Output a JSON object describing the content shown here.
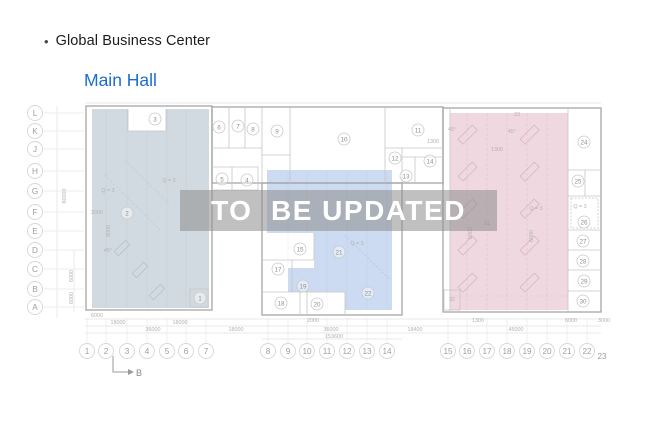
{
  "header": {
    "bullet": "•",
    "title": "Global Business Center",
    "subtitle": "Main Hall"
  },
  "watermark": "TO  BE UPDATED",
  "colors": {
    "subtitle_blue": "#1c6cd3",
    "zone_left": "#cdd6de",
    "zone_middle": "#c6d7f0",
    "zone_right": "#eed4dd",
    "watermark_band": "rgba(140,140,140,0.55)",
    "watermark_text": "#ffffff"
  },
  "plan": {
    "section_label": "B",
    "axis_rows": [
      {
        "label": "L",
        "y": 113
      },
      {
        "label": "K",
        "y": 131
      },
      {
        "label": "J",
        "y": 149
      },
      {
        "label": "H",
        "y": 171
      },
      {
        "label": "G",
        "y": 191
      },
      {
        "label": "F",
        "y": 212
      },
      {
        "label": "E",
        "y": 231
      },
      {
        "label": "D",
        "y": 250
      },
      {
        "label": "C",
        "y": 269
      },
      {
        "label": "B",
        "y": 289
      },
      {
        "label": "A",
        "y": 307
      }
    ],
    "axis_cols": [
      {
        "label": "1",
        "x": 87
      },
      {
        "label": "2",
        "x": 106
      },
      {
        "label": "3",
        "x": 127
      },
      {
        "label": "4",
        "x": 147
      },
      {
        "label": "5",
        "x": 167
      },
      {
        "label": "6",
        "x": 186
      },
      {
        "label": "7",
        "x": 206
      },
      {
        "label": "8",
        "x": 268
      },
      {
        "label": "9",
        "x": 288
      },
      {
        "label": "10",
        "x": 307
      },
      {
        "label": "11",
        "x": 327
      },
      {
        "label": "12",
        "x": 347
      },
      {
        "label": "13",
        "x": 367
      },
      {
        "label": "14",
        "x": 387
      },
      {
        "label": "15",
        "x": 448
      },
      {
        "label": "16",
        "x": 467
      },
      {
        "label": "17",
        "x": 487
      },
      {
        "label": "18",
        "x": 507
      },
      {
        "label": "19",
        "x": 527
      },
      {
        "label": "20",
        "x": 547
      },
      {
        "label": "21",
        "x": 567
      },
      {
        "label": "22",
        "x": 587
      },
      {
        "label": "23",
        "x": 602,
        "plain": true
      }
    ],
    "rooms": [
      {
        "n": "1",
        "x": 200,
        "y": 298
      },
      {
        "n": "2",
        "x": 127,
        "y": 213
      },
      {
        "n": "3",
        "x": 155,
        "y": 119
      },
      {
        "n": "4",
        "x": 247,
        "y": 180
      },
      {
        "n": "5",
        "x": 222,
        "y": 179
      },
      {
        "n": "6",
        "x": 219,
        "y": 127
      },
      {
        "n": "7",
        "x": 238,
        "y": 126
      },
      {
        "n": "8",
        "x": 253,
        "y": 129
      },
      {
        "n": "9",
        "x": 277,
        "y": 131
      },
      {
        "n": "10",
        "x": 344,
        "y": 139
      },
      {
        "n": "11",
        "x": 418,
        "y": 130
      },
      {
        "n": "12",
        "x": 395,
        "y": 158
      },
      {
        "n": "13",
        "x": 406,
        "y": 176
      },
      {
        "n": "14",
        "x": 430,
        "y": 161
      },
      {
        "n": "15",
        "x": 300,
        "y": 249
      },
      {
        "n": "17",
        "x": 278,
        "y": 269
      },
      {
        "n": "18",
        "x": 281,
        "y": 303
      },
      {
        "n": "19",
        "x": 303,
        "y": 286
      },
      {
        "n": "20",
        "x": 317,
        "y": 304
      },
      {
        "n": "21",
        "x": 339,
        "y": 252
      },
      {
        "n": "22",
        "x": 368,
        "y": 293
      },
      {
        "n": "24",
        "x": 584,
        "y": 142
      },
      {
        "n": "25",
        "x": 578,
        "y": 181
      },
      {
        "n": "26",
        "x": 584,
        "y": 222
      },
      {
        "n": "27",
        "x": 583,
        "y": 241
      },
      {
        "n": "28",
        "x": 583,
        "y": 261
      },
      {
        "n": "29",
        "x": 584,
        "y": 281
      },
      {
        "n": "30",
        "x": 583,
        "y": 301
      }
    ],
    "texts": [
      {
        "t": "23",
        "x": 517,
        "y": 116
      },
      {
        "t": "31",
        "x": 487,
        "y": 225
      },
      {
        "t": "32",
        "x": 452,
        "y": 301
      },
      {
        "t": "Q = 3",
        "x": 169,
        "y": 182
      },
      {
        "t": "Q = 3",
        "x": 108,
        "y": 192
      },
      {
        "t": "Q = 3",
        "x": 357,
        "y": 245
      },
      {
        "t": "Q = 3",
        "x": 536,
        "y": 210
      },
      {
        "t": "Q = 3",
        "x": 580,
        "y": 208
      },
      {
        "t": "45°",
        "x": 108,
        "y": 252
      },
      {
        "t": "45°",
        "x": 452,
        "y": 131
      },
      {
        "t": "45°",
        "x": 512,
        "y": 133
      },
      {
        "t": "2000",
        "x": 97,
        "y": 214
      },
      {
        "t": "1300",
        "x": 433,
        "y": 143
      },
      {
        "t": "1300",
        "x": 497,
        "y": 151
      },
      {
        "t": "6000",
        "x": 97,
        "y": 317
      },
      {
        "t": "18000",
        "x": 118,
        "y": 324
      },
      {
        "t": "18000",
        "x": 180,
        "y": 324
      },
      {
        "t": "36000",
        "x": 153,
        "y": 331
      },
      {
        "t": "18000",
        "x": 236,
        "y": 331
      },
      {
        "t": "2000",
        "x": 313,
        "y": 322
      },
      {
        "t": "36000",
        "x": 331,
        "y": 331
      },
      {
        "t": "153600",
        "x": 334,
        "y": 338
      },
      {
        "t": "18400",
        "x": 415,
        "y": 331
      },
      {
        "t": "1300",
        "x": 478,
        "y": 322
      },
      {
        "t": "45000",
        "x": 516,
        "y": 331
      },
      {
        "t": "6000",
        "x": 571,
        "y": 322
      },
      {
        "t": "3000",
        "x": 604,
        "y": 322
      }
    ],
    "vtexts": [
      {
        "t": "60000",
        "x": 66,
        "y": 196
      },
      {
        "t": "6000",
        "x": 73,
        "y": 276
      },
      {
        "t": "6000",
        "x": 73,
        "y": 298
      },
      {
        "t": "9000",
        "x": 110,
        "y": 231
      },
      {
        "t": "6000",
        "x": 472,
        "y": 233
      },
      {
        "t": "6000",
        "x": 533,
        "y": 236
      }
    ]
  }
}
